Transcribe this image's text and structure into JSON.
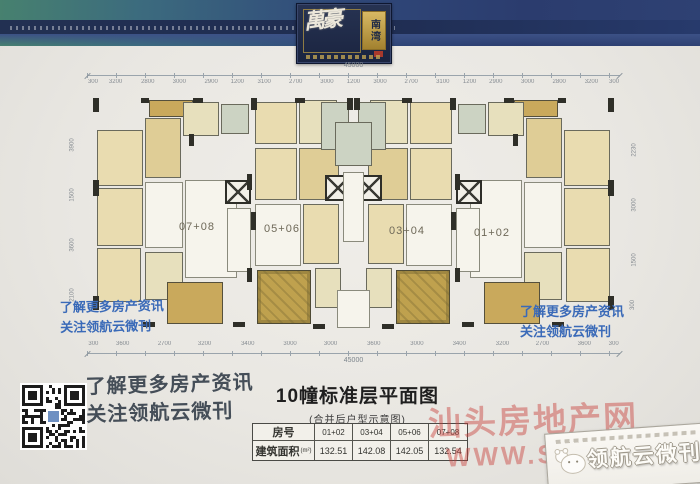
{
  "logo": {
    "script": "萬豪",
    "seal": "南湾"
  },
  "promo": {
    "line1": "了解更多房产资讯",
    "line2": "关注领航云微刊"
  },
  "title": {
    "main": "10幢标准层平面图",
    "sub": "(合并后户型示意图)"
  },
  "table": {
    "room_header": "房号",
    "unit_headers": [
      "01+02",
      "03+04",
      "05+06",
      "07+08"
    ],
    "area_label": "建筑面积",
    "area_unit": "(m²)",
    "areas": [
      "132.51",
      "142.08",
      "142.05",
      "132.54"
    ]
  },
  "watermark": {
    "line1": "汕头房地产网",
    "line2": "WWW.STFCW.NET"
  },
  "badge": {
    "text": "领航云微刊"
  },
  "plan": {
    "dims": {
      "total_top": "45000",
      "total_bottom": "45000",
      "top_segments": [
        "300",
        "3200",
        "2800",
        "3000",
        "2900",
        "1200",
        "3100",
        "2700",
        "3000",
        "1200",
        "3000",
        "2700",
        "3100",
        "1200",
        "2900",
        "3000",
        "2800",
        "3200",
        "300"
      ],
      "bottom_segments": [
        "300",
        "3600",
        "2700",
        "3200",
        "3400",
        "3000",
        "3000",
        "3600",
        "3000",
        "3400",
        "3200",
        "2700",
        "3600",
        "300"
      ],
      "left_labels": [
        {
          "t": "3900",
          "y": 80
        },
        {
          "t": "1500",
          "y": 130
        },
        {
          "t": "3600",
          "y": 180
        },
        {
          "t": "2100",
          "y": 230
        }
      ],
      "right_labels": [
        {
          "t": "2230",
          "y": 85
        },
        {
          "t": "3000",
          "y": 140
        },
        {
          "t": "1500",
          "y": 195
        },
        {
          "t": "300",
          "y": 240
        }
      ]
    },
    "units": [
      {
        "label": "07+08",
        "cx": 112,
        "cy": 165
      },
      {
        "label": "05+06",
        "cx": 197,
        "cy": 167
      },
      {
        "label": "03+04",
        "cx": 322,
        "cy": 169
      },
      {
        "label": "01+02",
        "cx": 407,
        "cy": 171
      }
    ],
    "rooms": [
      {
        "x": 12,
        "y": 68,
        "w": 46,
        "h": 56,
        "c": "b"
      },
      {
        "x": 12,
        "y": 126,
        "w": 46,
        "h": 58,
        "c": "b"
      },
      {
        "x": 12,
        "y": 186,
        "w": 44,
        "h": 54,
        "c": "b"
      },
      {
        "x": 60,
        "y": 56,
        "w": 36,
        "h": 60,
        "c": "b2"
      },
      {
        "x": 64,
        "y": 38,
        "w": 44,
        "h": 17,
        "c": "g"
      },
      {
        "x": 98,
        "y": 40,
        "w": 36,
        "h": 34,
        "c": "lo"
      },
      {
        "x": 136,
        "y": 42,
        "w": 28,
        "h": 30,
        "c": "gr"
      },
      {
        "x": 60,
        "y": 120,
        "w": 38,
        "h": 66,
        "c": "w"
      },
      {
        "x": 100,
        "y": 118,
        "w": 52,
        "h": 98,
        "c": "w"
      },
      {
        "x": 60,
        "y": 190,
        "w": 38,
        "h": 48,
        "c": "lo"
      },
      {
        "x": 82,
        "y": 220,
        "w": 56,
        "h": 42,
        "c": "g"
      },
      {
        "x": 140,
        "y": 118,
        "w": 26,
        "h": 24,
        "c": "el"
      },
      {
        "x": 142,
        "y": 146,
        "w": 24,
        "h": 64,
        "c": "w"
      },
      {
        "x": 170,
        "y": 40,
        "w": 42,
        "h": 42,
        "c": "b"
      },
      {
        "x": 214,
        "y": 38,
        "w": 38,
        "h": 44,
        "c": "lo"
      },
      {
        "x": 170,
        "y": 86,
        "w": 42,
        "h": 52,
        "c": "b"
      },
      {
        "x": 214,
        "y": 86,
        "w": 40,
        "h": 52,
        "c": "b2"
      },
      {
        "x": 170,
        "y": 142,
        "w": 46,
        "h": 62,
        "c": "w"
      },
      {
        "x": 218,
        "y": 142,
        "w": 36,
        "h": 60,
        "c": "b"
      },
      {
        "x": 172,
        "y": 208,
        "w": 54,
        "h": 54,
        "c": "g2"
      },
      {
        "x": 230,
        "y": 206,
        "w": 26,
        "h": 40,
        "c": "lo"
      },
      {
        "x": 240,
        "y": 113,
        "w": 26,
        "h": 26,
        "c": "el"
      },
      {
        "x": 236,
        "y": 40,
        "w": 28,
        "h": 48,
        "c": "gr"
      },
      {
        "x": 250,
        "y": 60,
        "w": 37,
        "h": 44,
        "c": "gr",
        "m": false
      },
      {
        "x": 258,
        "y": 110,
        "w": 21,
        "h": 70,
        "c": "w",
        "m": false
      },
      {
        "x": 252,
        "y": 228,
        "w": 33,
        "h": 38,
        "c": "w",
        "m": false
      }
    ],
    "walls": [
      {
        "x": 8,
        "y": 36,
        "w": 6,
        "h": 14
      },
      {
        "x": 8,
        "y": 118,
        "w": 6,
        "h": 16
      },
      {
        "x": 8,
        "y": 234,
        "w": 6,
        "h": 14
      },
      {
        "x": 56,
        "y": 36,
        "w": 8,
        "h": 5
      },
      {
        "x": 108,
        "y": 36,
        "w": 10,
        "h": 5
      },
      {
        "x": 162,
        "y": 112,
        "w": 5,
        "h": 16
      },
      {
        "x": 162,
        "y": 206,
        "w": 5,
        "h": 14
      },
      {
        "x": 166,
        "y": 36,
        "w": 6,
        "h": 12
      },
      {
        "x": 210,
        "y": 36,
        "w": 10,
        "h": 5
      },
      {
        "x": 262,
        "y": 36,
        "w": 6,
        "h": 12
      },
      {
        "x": 58,
        "y": 260,
        "w": 12,
        "h": 5
      },
      {
        "x": 148,
        "y": 260,
        "w": 12,
        "h": 5
      },
      {
        "x": 228,
        "y": 262,
        "w": 12,
        "h": 5
      },
      {
        "x": 104,
        "y": 72,
        "w": 5,
        "h": 12
      },
      {
        "x": 166,
        "y": 150,
        "w": 5,
        "h": 18
      }
    ]
  }
}
